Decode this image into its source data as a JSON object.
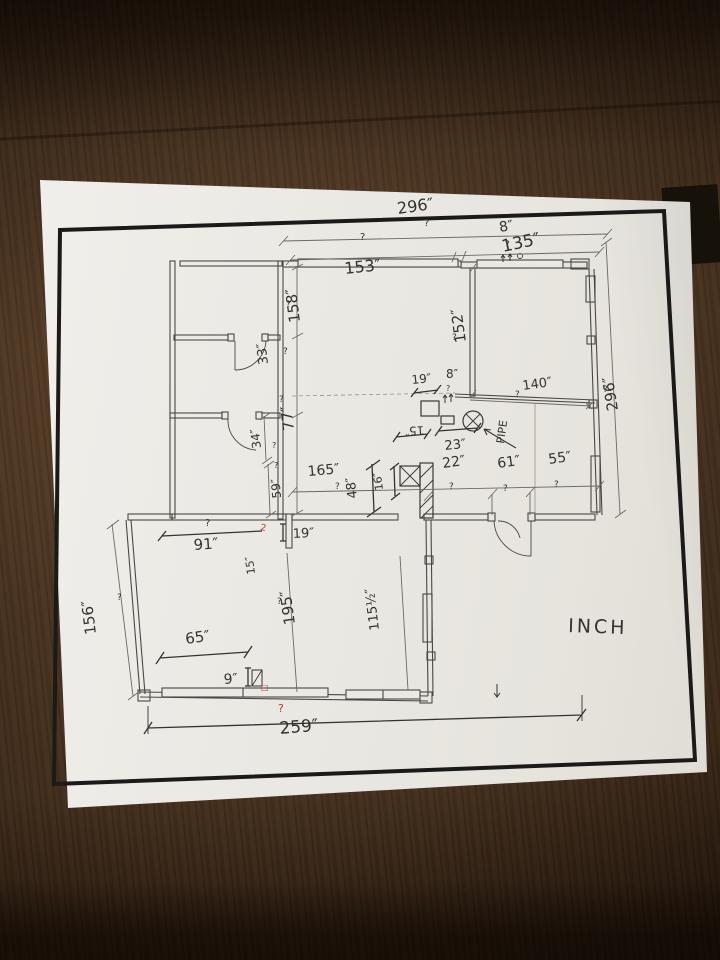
{
  "scene": {
    "description": "hand-annotated floor plan blueprint on dark wood table",
    "wood_color": "#4d3522",
    "paper_color": "#ebe9e4",
    "frame_color": "#1b1a18",
    "ink_color": "#35332f",
    "print_color": "#55534e",
    "red_color": "#b23b34"
  },
  "drawing": {
    "type": "floor-plan",
    "unit_note": "INCH",
    "labels": [
      {
        "t": "296″",
        "x": 398,
        "y": 214,
        "r": -8,
        "s": 16
      },
      {
        "t": "?",
        "x": 424,
        "y": 226,
        "r": 0,
        "s": 10
      },
      {
        "t": "8″",
        "x": 500,
        "y": 232,
        "r": -10,
        "s": 14
      },
      {
        "t": "?",
        "x": 505,
        "y": 247,
        "r": 0,
        "s": 9
      },
      {
        "t": "?",
        "x": 360,
        "y": 240,
        "r": 0,
        "s": 10
      },
      {
        "t": "135″",
        "x": 503,
        "y": 252,
        "r": -12,
        "s": 17
      },
      {
        "t": "153″",
        "x": 345,
        "y": 274,
        "r": -6,
        "s": 16
      },
      {
        "t": "158″",
        "x": 300,
        "y": 322,
        "r": -97,
        "s": 15
      },
      {
        "t": "?",
        "x": 286,
        "y": 307,
        "r": 0,
        "s": 9
      },
      {
        "t": "33″",
        "x": 268,
        "y": 364,
        "r": -97,
        "s": 13
      },
      {
        "t": "?",
        "x": 283,
        "y": 354,
        "r": 0,
        "s": 9
      },
      {
        "t": "77″",
        "x": 294,
        "y": 430,
        "r": -97,
        "s": 15
      },
      {
        "t": "?",
        "x": 279,
        "y": 402,
        "r": 0,
        "s": 9
      },
      {
        "t": "152″",
        "x": 466,
        "y": 342,
        "r": -98,
        "s": 15
      },
      {
        "t": "?",
        "x": 452,
        "y": 340,
        "r": 0,
        "s": 9
      },
      {
        "t": "296″",
        "x": 618,
        "y": 410,
        "r": -99,
        "s": 15
      },
      {
        "t": "?",
        "x": 603,
        "y": 392,
        "r": 0,
        "s": 9
      },
      {
        "t": "19″",
        "x": 412,
        "y": 384,
        "r": -6,
        "s": 12
      },
      {
        "t": "8″",
        "x": 446,
        "y": 378,
        "r": 0,
        "s": 12
      },
      {
        "t": "?",
        "x": 446,
        "y": 391,
        "r": 0,
        "s": 8
      },
      {
        "t": "?",
        "x": 515,
        "y": 397,
        "r": 0,
        "s": 9
      },
      {
        "t": "140″",
        "x": 523,
        "y": 390,
        "r": -8,
        "s": 13
      },
      {
        "t": "PIPE",
        "x": 504,
        "y": 444,
        "r": -82,
        "s": 11
      },
      {
        "t": "23″",
        "x": 445,
        "y": 450,
        "r": -6,
        "s": 13
      },
      {
        "t": "15″",
        "x": 424,
        "y": 426,
        "r": 176,
        "s": 12
      },
      {
        "t": "165″",
        "x": 308,
        "y": 476,
        "r": -5,
        "s": 14
      },
      {
        "t": "?",
        "x": 335,
        "y": 489,
        "r": 0,
        "s": 9
      },
      {
        "t": "48″",
        "x": 357,
        "y": 498,
        "r": -97,
        "s": 13
      },
      {
        "t": "16″",
        "x": 383,
        "y": 490,
        "r": -97,
        "s": 11
      },
      {
        "t": "22″",
        "x": 443,
        "y": 468,
        "r": -8,
        "s": 14
      },
      {
        "t": "?",
        "x": 449,
        "y": 489,
        "r": 0,
        "s": 9
      },
      {
        "t": "61″",
        "x": 498,
        "y": 468,
        "r": -8,
        "s": 14
      },
      {
        "t": "?",
        "x": 503,
        "y": 491,
        "r": 0,
        "s": 9
      },
      {
        "t": "55″",
        "x": 549,
        "y": 464,
        "r": -8,
        "s": 14
      },
      {
        "t": "?",
        "x": 554,
        "y": 487,
        "r": 0,
        "s": 9
      },
      {
        "t": "34″",
        "x": 261,
        "y": 448,
        "r": -97,
        "s": 12
      },
      {
        "t": "?",
        "x": 272,
        "y": 448,
        "r": 0,
        "s": 8
      },
      {
        "t": "59″",
        "x": 281,
        "y": 498,
        "r": -95,
        "s": 12
      },
      {
        "t": "?",
        "x": 274,
        "y": 468,
        "r": 0,
        "s": 8
      },
      {
        "t": "91″",
        "x": 194,
        "y": 550,
        "r": -4,
        "s": 15
      },
      {
        "t": "?",
        "x": 205,
        "y": 526,
        "r": 0,
        "s": 10
      },
      {
        "t": "19″",
        "x": 293,
        "y": 538,
        "r": -3,
        "s": 13
      },
      {
        "t": "15″",
        "x": 255,
        "y": 574,
        "r": -97,
        "s": 11
      },
      {
        "t": "156″",
        "x": 96,
        "y": 634,
        "r": -97,
        "s": 15
      },
      {
        "t": "?",
        "x": 117,
        "y": 600,
        "r": 0,
        "s": 9
      },
      {
        "t": "195″",
        "x": 295,
        "y": 624,
        "r": -98,
        "s": 15
      },
      {
        "t": "?",
        "x": 277,
        "y": 604,
        "r": 0,
        "s": 9
      },
      {
        "t": "115½″",
        "x": 379,
        "y": 630,
        "r": -97,
        "s": 13
      },
      {
        "t": "INCH",
        "x": 568,
        "y": 632,
        "r": 2,
        "s": 19,
        "ls": 3
      },
      {
        "t": "65″",
        "x": 186,
        "y": 644,
        "r": -8,
        "s": 15
      },
      {
        "t": "9″",
        "x": 224,
        "y": 684,
        "r": -4,
        "s": 14
      },
      {
        "t": "259″",
        "x": 280,
        "y": 734,
        "r": -5,
        "s": 17
      },
      {
        "t": "?",
        "x": 278,
        "y": 712,
        "r": 0,
        "s": 11,
        "c": "#b23b34"
      },
      {
        "t": "□",
        "x": 261,
        "y": 690,
        "r": 0,
        "s": 8,
        "c": "#b23b34"
      },
      {
        "t": "2",
        "x": 260,
        "y": 530,
        "r": 10,
        "s": 9,
        "c": "#b23b34"
      }
    ]
  }
}
